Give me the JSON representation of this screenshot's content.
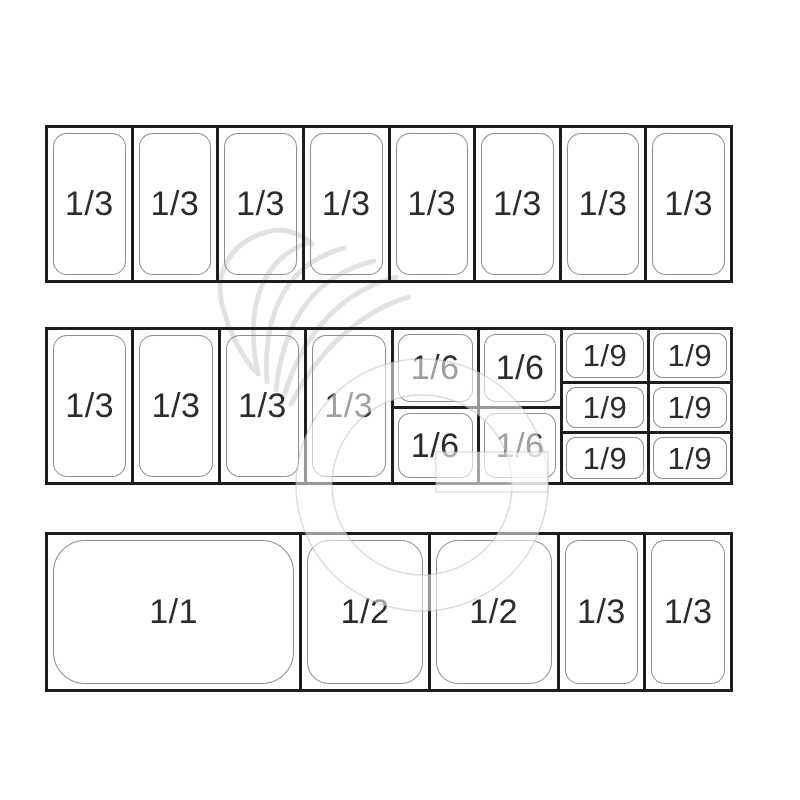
{
  "diagram": {
    "title": "gastronorm-pan-configuration",
    "colors": {
      "line": "#1d1d1d",
      "pan_stroke": "#8e8e8e",
      "text": "#2c2c2c",
      "watermark": "#dcdcdc",
      "background": "#ffffff"
    },
    "watermark": {
      "name": "chef-hat-g-logo"
    },
    "rows": {
      "top": {
        "cells": [
          {
            "label": "1/3"
          },
          {
            "label": "1/3"
          },
          {
            "label": "1/3"
          },
          {
            "label": "1/3"
          },
          {
            "label": "1/3"
          },
          {
            "label": "1/3"
          },
          {
            "label": "1/3"
          },
          {
            "label": "1/3"
          }
        ]
      },
      "middle": {
        "thirds": [
          {
            "label": "1/3"
          },
          {
            "label": "1/3"
          },
          {
            "label": "1/3"
          },
          {
            "label": "1/3"
          }
        ],
        "sixths": [
          {
            "label": "1/6"
          },
          {
            "label": "1/6"
          },
          {
            "label": "1/6"
          },
          {
            "label": "1/6"
          }
        ],
        "ninths": [
          {
            "label": "1/9"
          },
          {
            "label": "1/9"
          },
          {
            "label": "1/9"
          },
          {
            "label": "1/9"
          },
          {
            "label": "1/9"
          },
          {
            "label": "1/9"
          }
        ]
      },
      "bottom": {
        "cells": [
          {
            "label": "1/1",
            "span": 3
          },
          {
            "label": "1/2",
            "span": 1.5
          },
          {
            "label": "1/2",
            "span": 1.5
          },
          {
            "label": "1/3",
            "span": 1
          },
          {
            "label": "1/3",
            "span": 1
          }
        ]
      }
    }
  }
}
